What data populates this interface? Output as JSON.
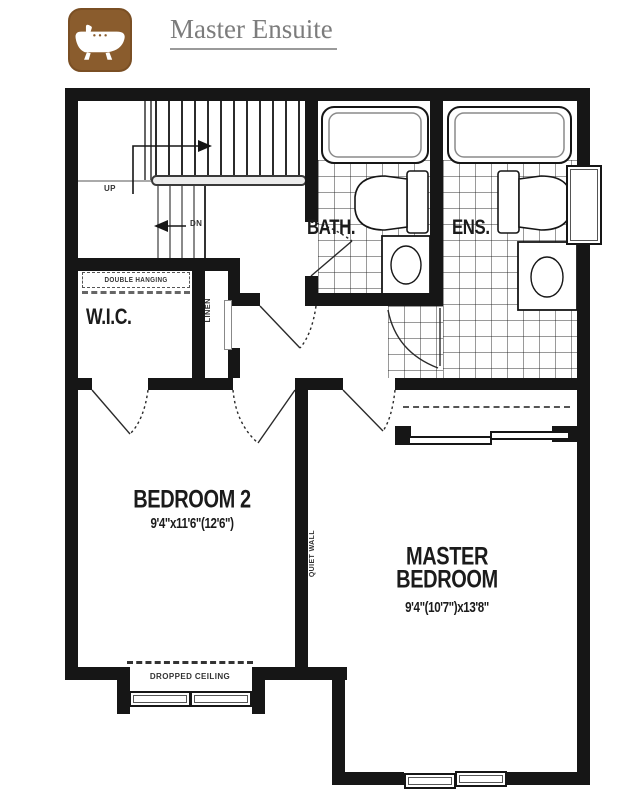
{
  "header": {
    "title": "Master Ensuite",
    "icon": "bathtub-icon",
    "icon_bg": "#8a5c2d",
    "title_color": "#7c7c7c"
  },
  "plan": {
    "wall_color": "#161616",
    "rooms": {
      "bath": {
        "label": "BATH."
      },
      "ensuite": {
        "label": "ENS."
      },
      "wic": {
        "label": "W.I.C."
      },
      "linen": {
        "label": "LINEN"
      },
      "bedroom2": {
        "label": "BEDROOM 2",
        "dims": "9'4\"x11'6\"(12'6\")"
      },
      "master": {
        "label_line1": "MASTER",
        "label_line2": "BEDROOM",
        "dims": "9'4\"(10'7\")x13'8\""
      }
    },
    "annotations": {
      "double_hanging": "DOUBLE HANGING",
      "dropped_ceiling": "DROPPED CEILING",
      "quiet_wall": "QUIET WALL",
      "stairs_up": "UP",
      "stairs_dn": "DN"
    }
  }
}
